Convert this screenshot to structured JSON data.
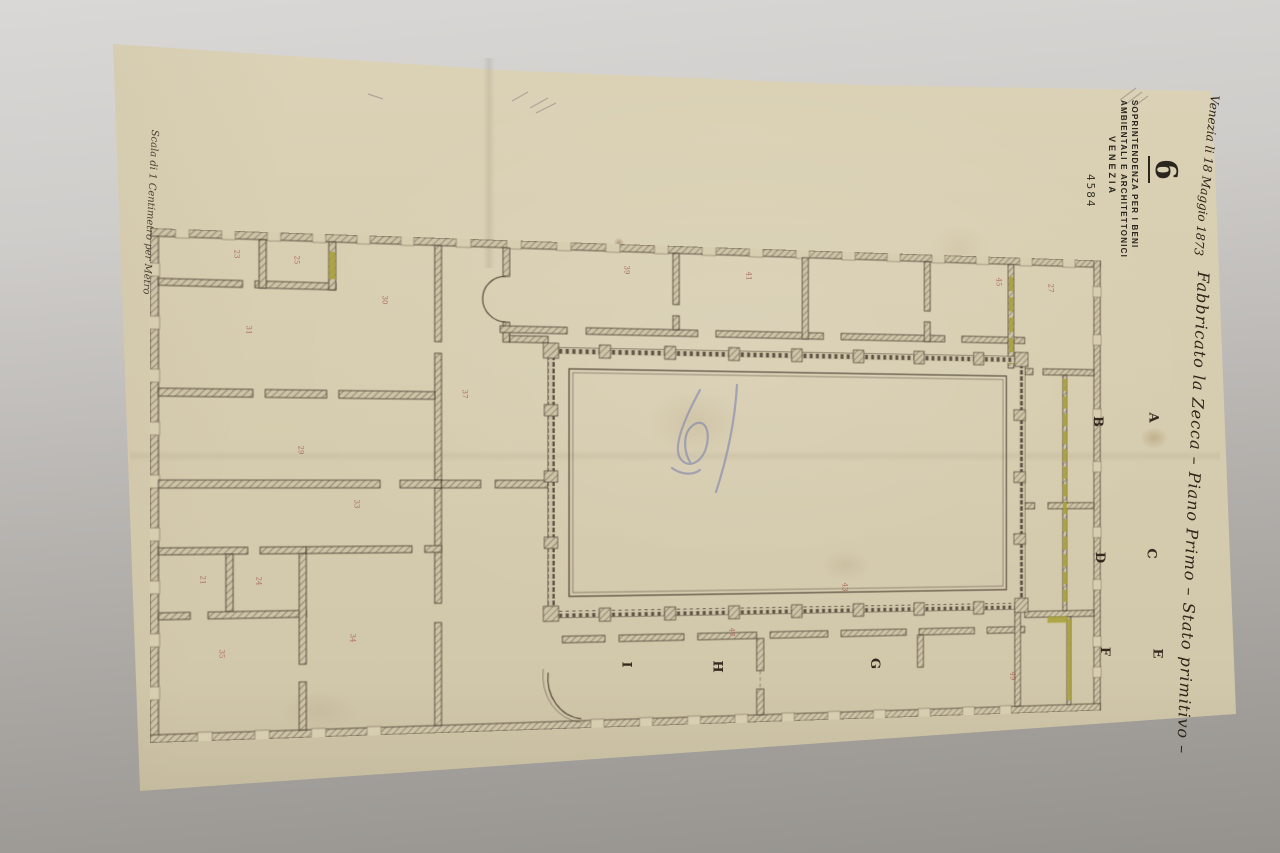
{
  "stamp": {
    "big_number": "6",
    "lines": [
      "SOPRINTENDENZA PER I BENI",
      "AMBIENTALI E ARCHITETTONICI",
      "VENEZIA"
    ],
    "registry_number": "4584"
  },
  "annotations": {
    "date_note": "Venezia li 18 Maggio 1873",
    "title": "Fabbricato la Zecca – Piano Primo – Stato primitivo –",
    "scale_note": "Scala di 1 Centimetro per Metro"
  },
  "plan": {
    "room_letters": [
      {
        "label": "A"
      },
      {
        "label": "B"
      },
      {
        "label": "C"
      },
      {
        "label": "D"
      },
      {
        "label": "E"
      },
      {
        "label": "F"
      },
      {
        "label": "G"
      },
      {
        "label": "H"
      },
      {
        "label": "I"
      }
    ],
    "room_numbers": [
      {
        "value": "23"
      },
      {
        "value": "25"
      },
      {
        "value": "30"
      },
      {
        "value": "31"
      },
      {
        "value": "29"
      },
      {
        "value": "33"
      },
      {
        "value": "21"
      },
      {
        "value": "24"
      },
      {
        "value": "35"
      },
      {
        "value": "34"
      },
      {
        "value": "37"
      },
      {
        "value": "39"
      },
      {
        "value": "41"
      },
      {
        "value": "45"
      },
      {
        "value": "47"
      },
      {
        "value": "49"
      },
      {
        "value": "27"
      },
      {
        "value": "43"
      }
    ]
  },
  "colors": {
    "paper": "#d6ccb0",
    "highlight_yellow": "#aaa13b",
    "number_red": "#a85a4e",
    "ink": "#453a2c",
    "pencil_blue": "#7d84ae",
    "backdrop_gray": "#b3b0ac"
  }
}
